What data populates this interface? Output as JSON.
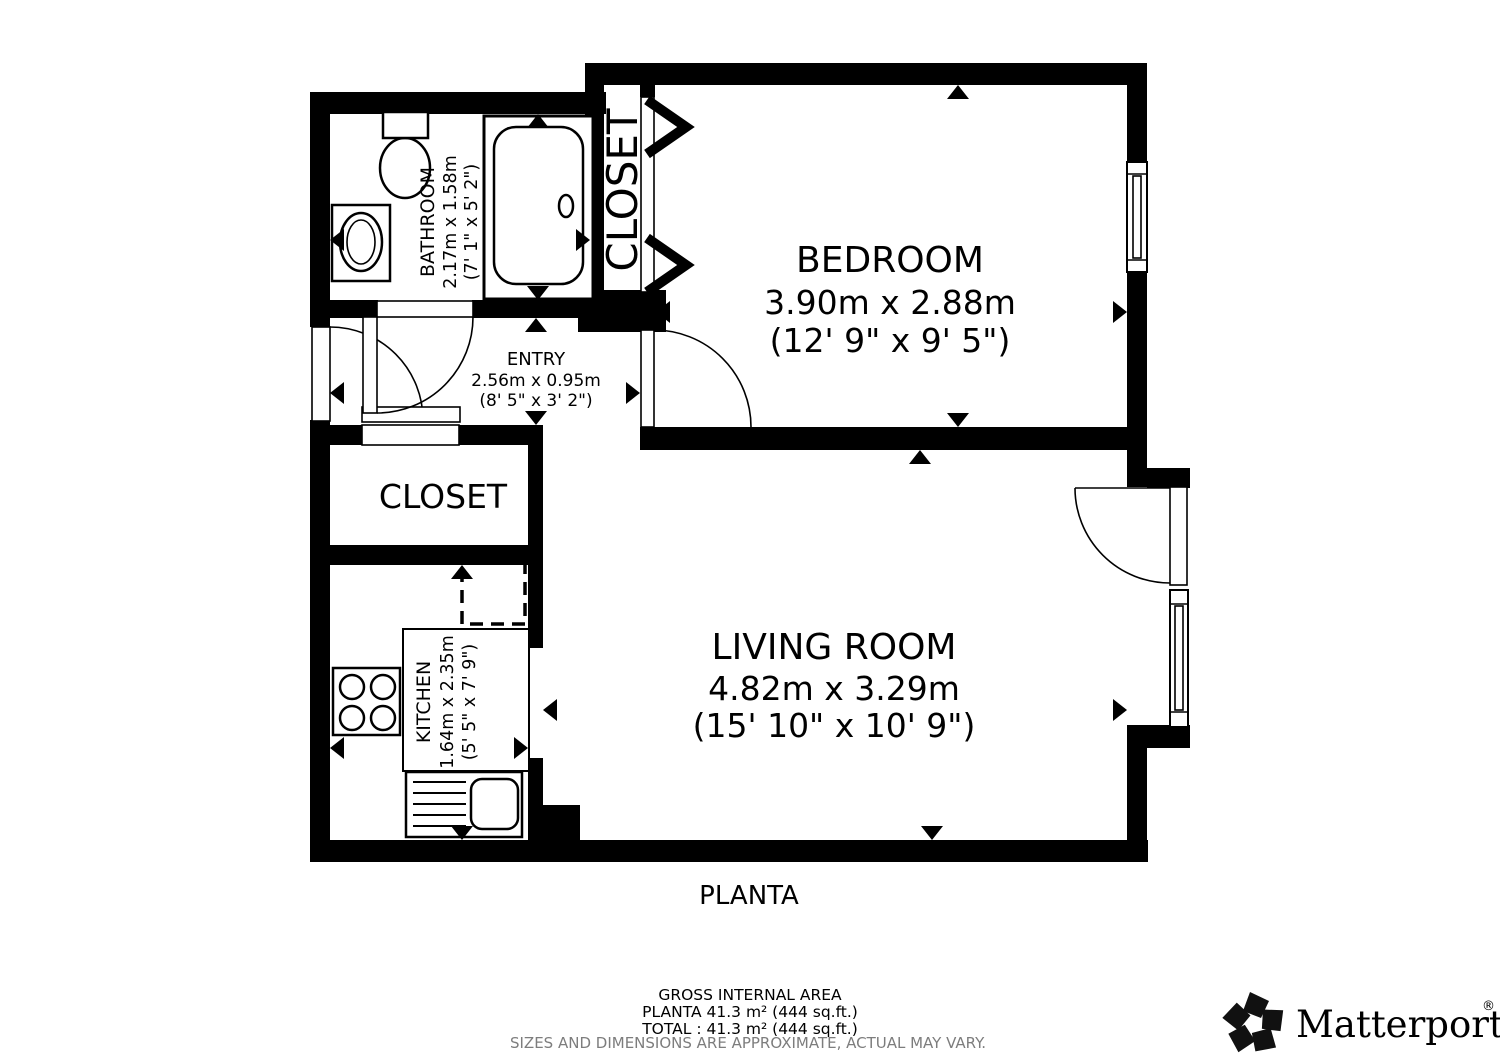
{
  "plan": {
    "floor_label": "PLANTA",
    "rooms": {
      "bathroom": {
        "name": "BATHROOM",
        "metric": "2.17m x 1.58m",
        "imperial": "(7' 1\" x 5' 2\")"
      },
      "closet_top": {
        "name": "CLOSET"
      },
      "bedroom": {
        "name": "BEDROOM",
        "metric": "3.90m x 2.88m",
        "imperial": "(12' 9\" x 9' 5\")"
      },
      "entry": {
        "name": "ENTRY",
        "metric": "2.56m x 0.95m",
        "imperial": "(8' 5\" x 3' 2\")"
      },
      "closet": {
        "name": "CLOSET"
      },
      "kitchen": {
        "name": "KITCHEN",
        "metric": "1.64m x 2.35m",
        "imperial": "(5' 5\" x 7' 9\")"
      },
      "living_room": {
        "name": "LIVING ROOM",
        "metric": "4.82m x 3.29m",
        "imperial": "(15' 10\" x 10' 9\")"
      }
    }
  },
  "footer": {
    "gross_area_title": "GROSS INTERNAL AREA",
    "planta_area": "PLANTA 41.3 m² (444 sq.ft.)",
    "total_area": "TOTAL :  41.3 m² (444 sq.ft.)",
    "disclaimer": "SIZES AND DIMENSIONS ARE APPROXIMATE, ACTUAL MAY VARY."
  },
  "brand": {
    "wordmark": "Matterport",
    "registered_mark": "®"
  },
  "colors": {
    "wall": "#000000",
    "background": "#ffffff",
    "disclaimer_gray": "#7d7d7d"
  }
}
